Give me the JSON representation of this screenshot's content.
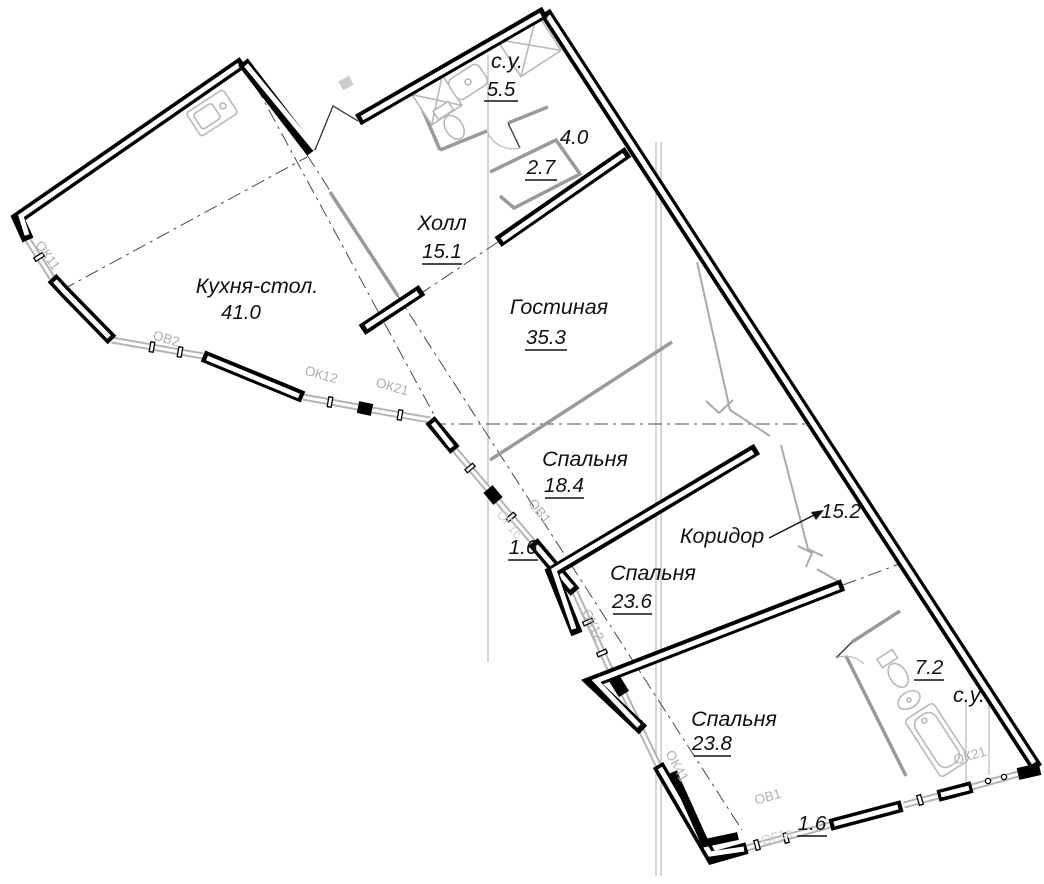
{
  "plan": {
    "type": "apartment-floor-plan",
    "rooms": [
      {
        "id": "su-top",
        "name": "с.у.",
        "area": "5.5"
      },
      {
        "id": "niche-40",
        "name": "",
        "area": "4.0"
      },
      {
        "id": "closet-27",
        "name": "",
        "area": "2.7"
      },
      {
        "id": "hall",
        "name": "Холл",
        "area": "15.1"
      },
      {
        "id": "kitchen",
        "name": "Кухня-стол.",
        "area": "41.0"
      },
      {
        "id": "living",
        "name": "Гостиная",
        "area": "35.3"
      },
      {
        "id": "bedroom-1",
        "name": "Спальня",
        "area": "18.4"
      },
      {
        "id": "balcony-1",
        "name": "",
        "area": "1.6"
      },
      {
        "id": "corridor",
        "name": "Коридор",
        "area": "15.2"
      },
      {
        "id": "bedroom-2",
        "name": "Спальня",
        "area": "23.6"
      },
      {
        "id": "bedroom-3",
        "name": "Спальня",
        "area": "23.8"
      },
      {
        "id": "su-bottom",
        "name": "с.у.",
        "area": "7.2"
      },
      {
        "id": "balcony-2",
        "name": "",
        "area": "1.6"
      }
    ],
    "windows": {
      "ok11": "ОК11",
      "ov2": "ОВ2",
      "ok12a": "ОК12",
      "ok21a": "ОК21",
      "ov1a": "ОВ1",
      "og1sa": "ОГ1с",
      "ok12b": "ОК12",
      "ok41": "ОК41",
      "ov1b": "ОВ1",
      "og1sb": "ОГ1с",
      "ok21b": "ОК21"
    },
    "colors": {
      "wall": "#000000",
      "glazing": "#b4b4b4",
      "partition": "#9a9a9a",
      "axis": "#4a4a4a",
      "label": "#111111",
      "window_label": "#b0b0b0",
      "background": "#ffffff"
    }
  }
}
